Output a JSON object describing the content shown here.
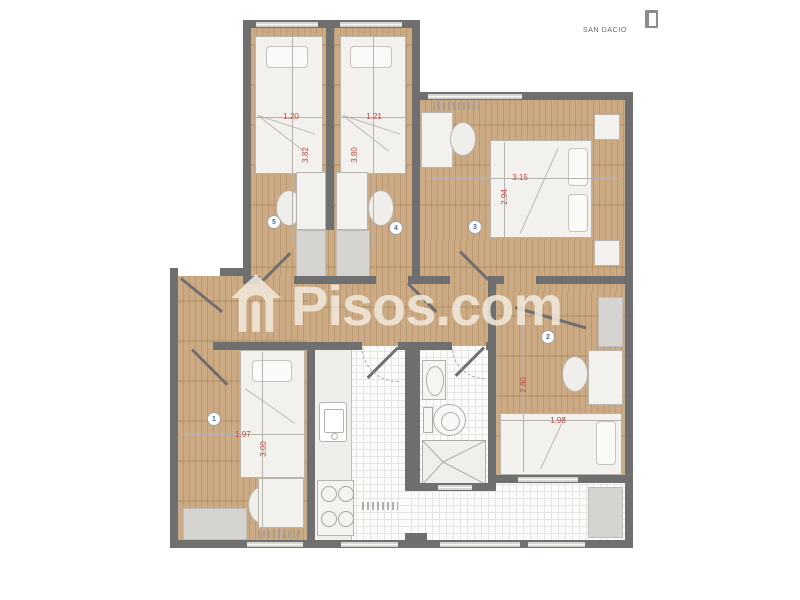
{
  "header": {
    "location_label": "SAN DACIO",
    "logo_icon": "door-icon"
  },
  "watermark": {
    "brand": "Pisos.com",
    "icon": "house-icon"
  },
  "rooms": [
    {
      "number": "1",
      "width_m": "1.97",
      "length_m": "3.00"
    },
    {
      "number": "2",
      "width_m": "1.98",
      "length_m": "2.80"
    },
    {
      "number": "3",
      "width_m": "3.15",
      "length_m": "2.94"
    },
    {
      "number": "4",
      "width_m": "1.21",
      "length_m": "3.80"
    },
    {
      "number": "5",
      "width_m": "1.20",
      "length_m": "3.82"
    }
  ],
  "colors": {
    "wall": "#6f6f6f",
    "wood_floor": "#c9a77d",
    "tile_floor": "#fcfcfb",
    "dimension_text": "#bf4840",
    "room_number_text": "#4a6fa5",
    "watermark": "rgba(240,232,219,0.88)"
  }
}
